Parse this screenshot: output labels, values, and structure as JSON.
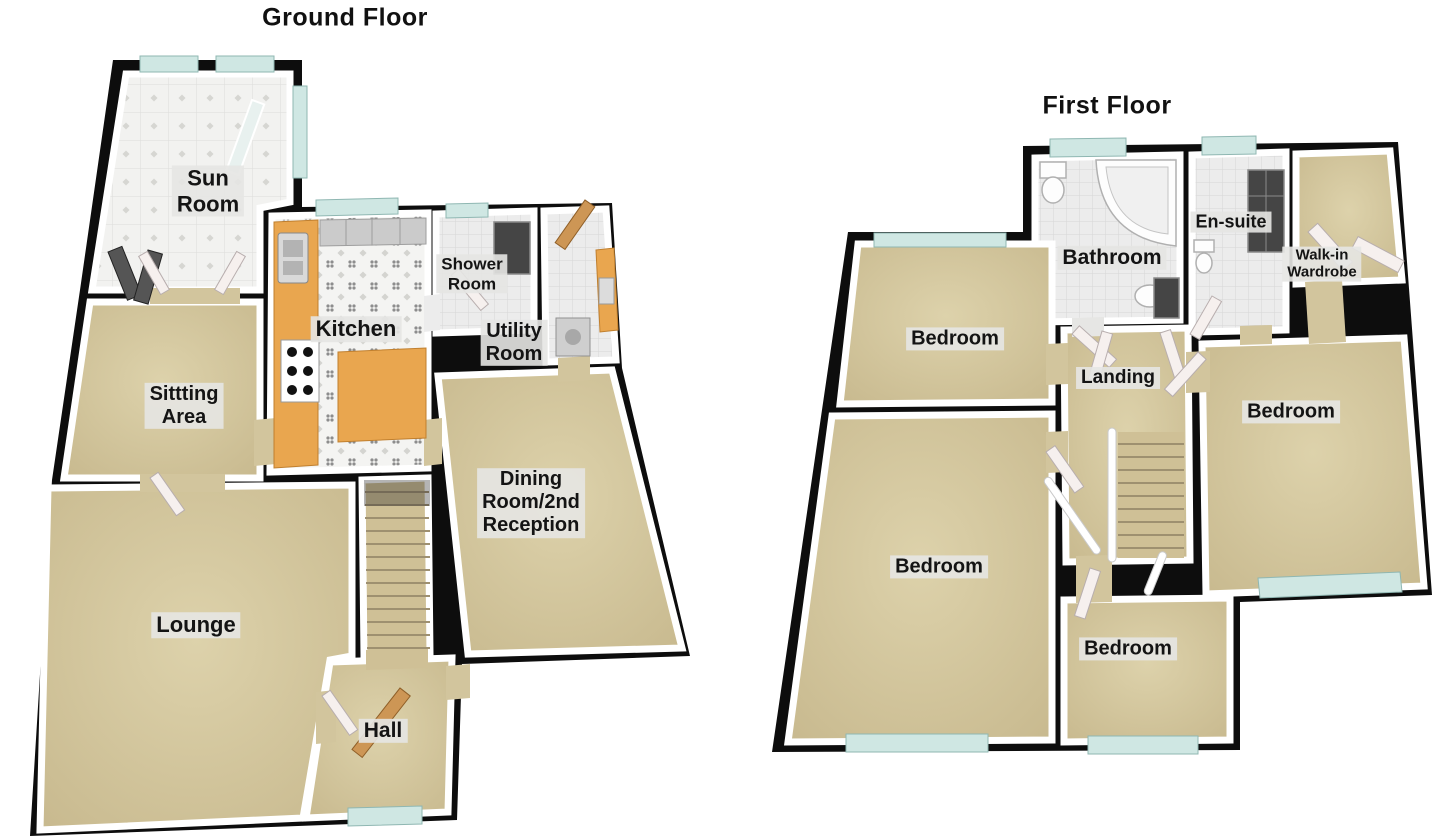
{
  "colors": {
    "wall_black": "#0d0d0d",
    "floor_beige": "#d2c59d",
    "tile_gray": "#ececec",
    "window_glass": "#cfe7e3",
    "kitchen_counter_orange": "#e9a64f",
    "wood_door": "#cd9655",
    "label_background": "#e5e5e3"
  },
  "floors": [
    {
      "id": "ground",
      "title": "Ground Floor",
      "rooms": [
        {
          "id": "sun-room",
          "label": "Sun\nRoom",
          "x": 208,
          "y": 191,
          "size": 22
        },
        {
          "id": "shower-room",
          "label": "Shower\nRoom",
          "x": 472,
          "y": 274,
          "size": 17
        },
        {
          "id": "kitchen",
          "label": "Kitchen",
          "x": 356,
          "y": 329,
          "size": 22
        },
        {
          "id": "utility-room",
          "label": "Utility\nRoom",
          "x": 514,
          "y": 343,
          "size": 20
        },
        {
          "id": "sitting-area",
          "label": "Sittting\nArea",
          "x": 184,
          "y": 406,
          "size": 20
        },
        {
          "id": "dining-room",
          "label": "Dining\nRoom/2nd\nReception",
          "x": 531,
          "y": 503,
          "size": 20
        },
        {
          "id": "lounge",
          "label": "Lounge",
          "x": 196,
          "y": 625,
          "size": 22
        },
        {
          "id": "hall",
          "label": "Hall",
          "x": 383,
          "y": 731,
          "size": 21
        }
      ]
    },
    {
      "id": "first",
      "title": "First Floor",
      "rooms": [
        {
          "id": "bathroom",
          "label": "Bathroom",
          "x": 1112,
          "y": 258,
          "size": 21
        },
        {
          "id": "en-suite",
          "label": "En-suite",
          "x": 1231,
          "y": 222,
          "size": 18
        },
        {
          "id": "walk-in-wardrobe",
          "label": "Walk-in\nWardrobe",
          "x": 1322,
          "y": 264,
          "size": 15
        },
        {
          "id": "bedroom-top-left",
          "label": "Bedroom",
          "x": 955,
          "y": 339,
          "size": 20
        },
        {
          "id": "landing",
          "label": "Landing",
          "x": 1118,
          "y": 378,
          "size": 19
        },
        {
          "id": "bedroom-right",
          "label": "Bedroom",
          "x": 1291,
          "y": 412,
          "size": 20
        },
        {
          "id": "bedroom-bottom-left",
          "label": "Bedroom",
          "x": 939,
          "y": 567,
          "size": 20
        },
        {
          "id": "bedroom-bottom-centre",
          "label": "Bedroom",
          "x": 1128,
          "y": 649,
          "size": 20
        }
      ]
    }
  ]
}
